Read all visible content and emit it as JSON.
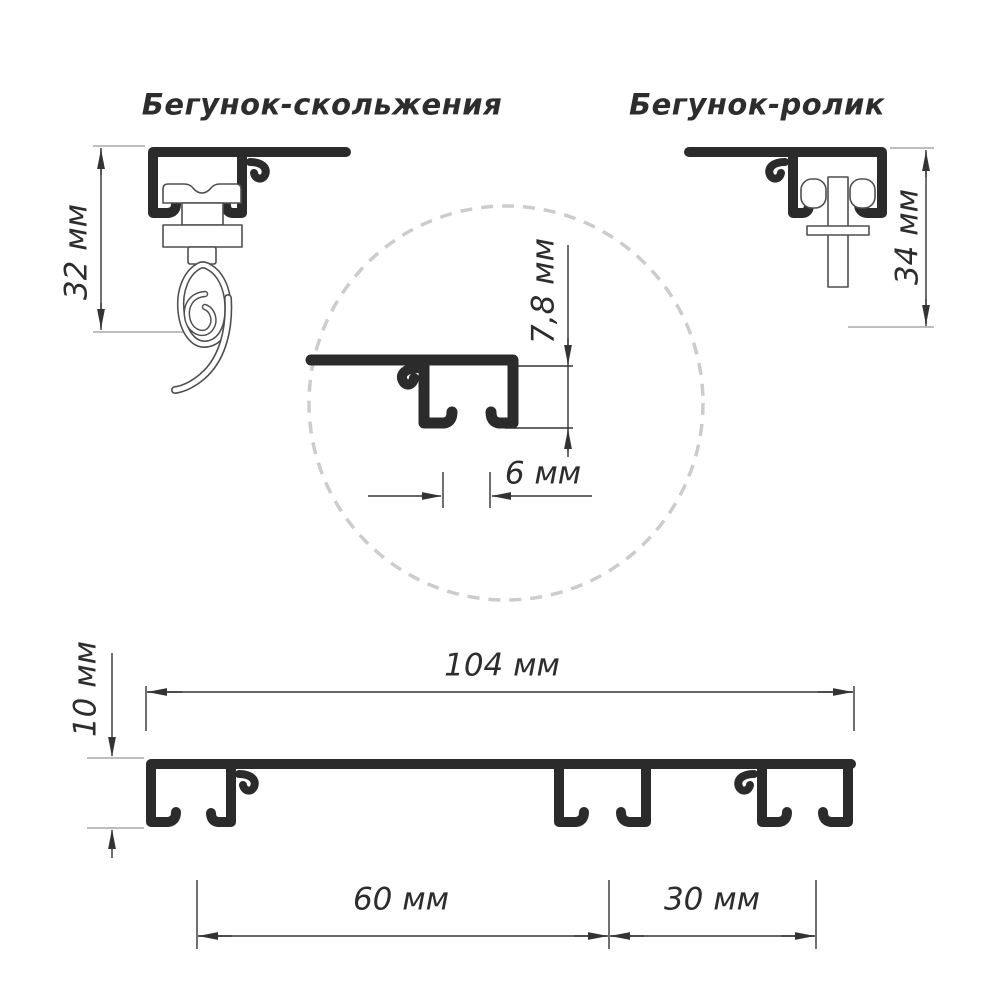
{
  "diagram": {
    "titles": {
      "left": "Бегунок-скольжения",
      "right": "Бегунок-ролик"
    },
    "dimensions": {
      "runner_left_height": "32 мм",
      "runner_right_height": "34 мм",
      "detail_height": "7,8 мм",
      "detail_slot_width": "6 мм",
      "profile_total_width": "104 мм",
      "profile_height": "10 мм",
      "left_channel_to_middle": "60 мм",
      "middle_to_right_channel": "30 мм"
    },
    "colors": {
      "ink": "#2b2b2b",
      "part_outline": "#4f4f4f",
      "dim_line": "#333333",
      "ext_line": "#a8a8a8",
      "circle_dash": "#cccccc",
      "background": "#ffffff"
    }
  }
}
